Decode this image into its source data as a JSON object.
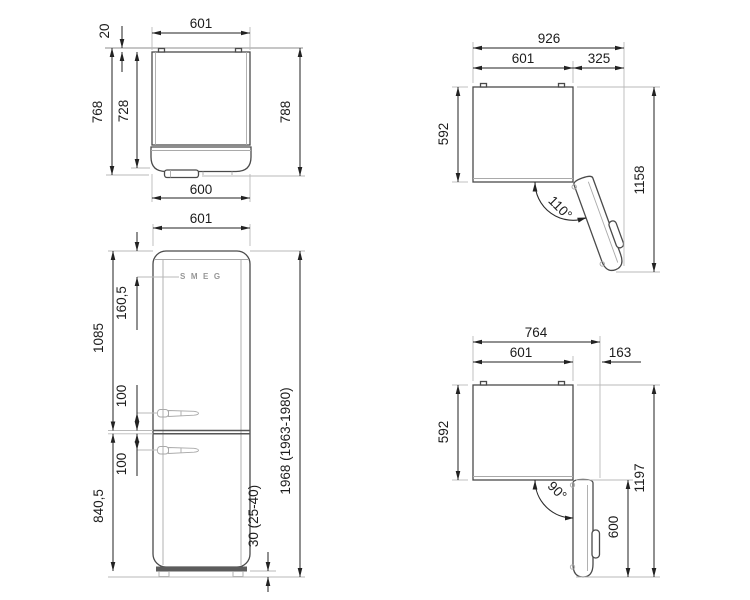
{
  "logo_text": "SMEG",
  "dims": {
    "top_closed": {
      "width_top": "601",
      "wall_gap": "20",
      "depth_overall": "768",
      "depth_body": "728",
      "depth_with_handle": "788",
      "width_bottom": "600"
    },
    "front": {
      "width": "601",
      "logo_from_top": "160,5",
      "upper_section": "1085",
      "handle_offset_upper": "100",
      "handle_offset_lower": "100",
      "lower_section": "840,5",
      "total_height": "1968 (1963-1980)",
      "feet_height": "30 (25-40)"
    },
    "open_110": {
      "overall_width": "926",
      "body_width": "601",
      "door_projection": "325",
      "body_depth": "592",
      "overall_depth": "1158",
      "door_angle": "110°"
    },
    "open_90": {
      "overall_width": "764",
      "body_width": "601",
      "door_projection": "163",
      "body_depth": "592",
      "overall_depth": "1197",
      "door_depth": "600",
      "door_angle": "90°"
    }
  }
}
